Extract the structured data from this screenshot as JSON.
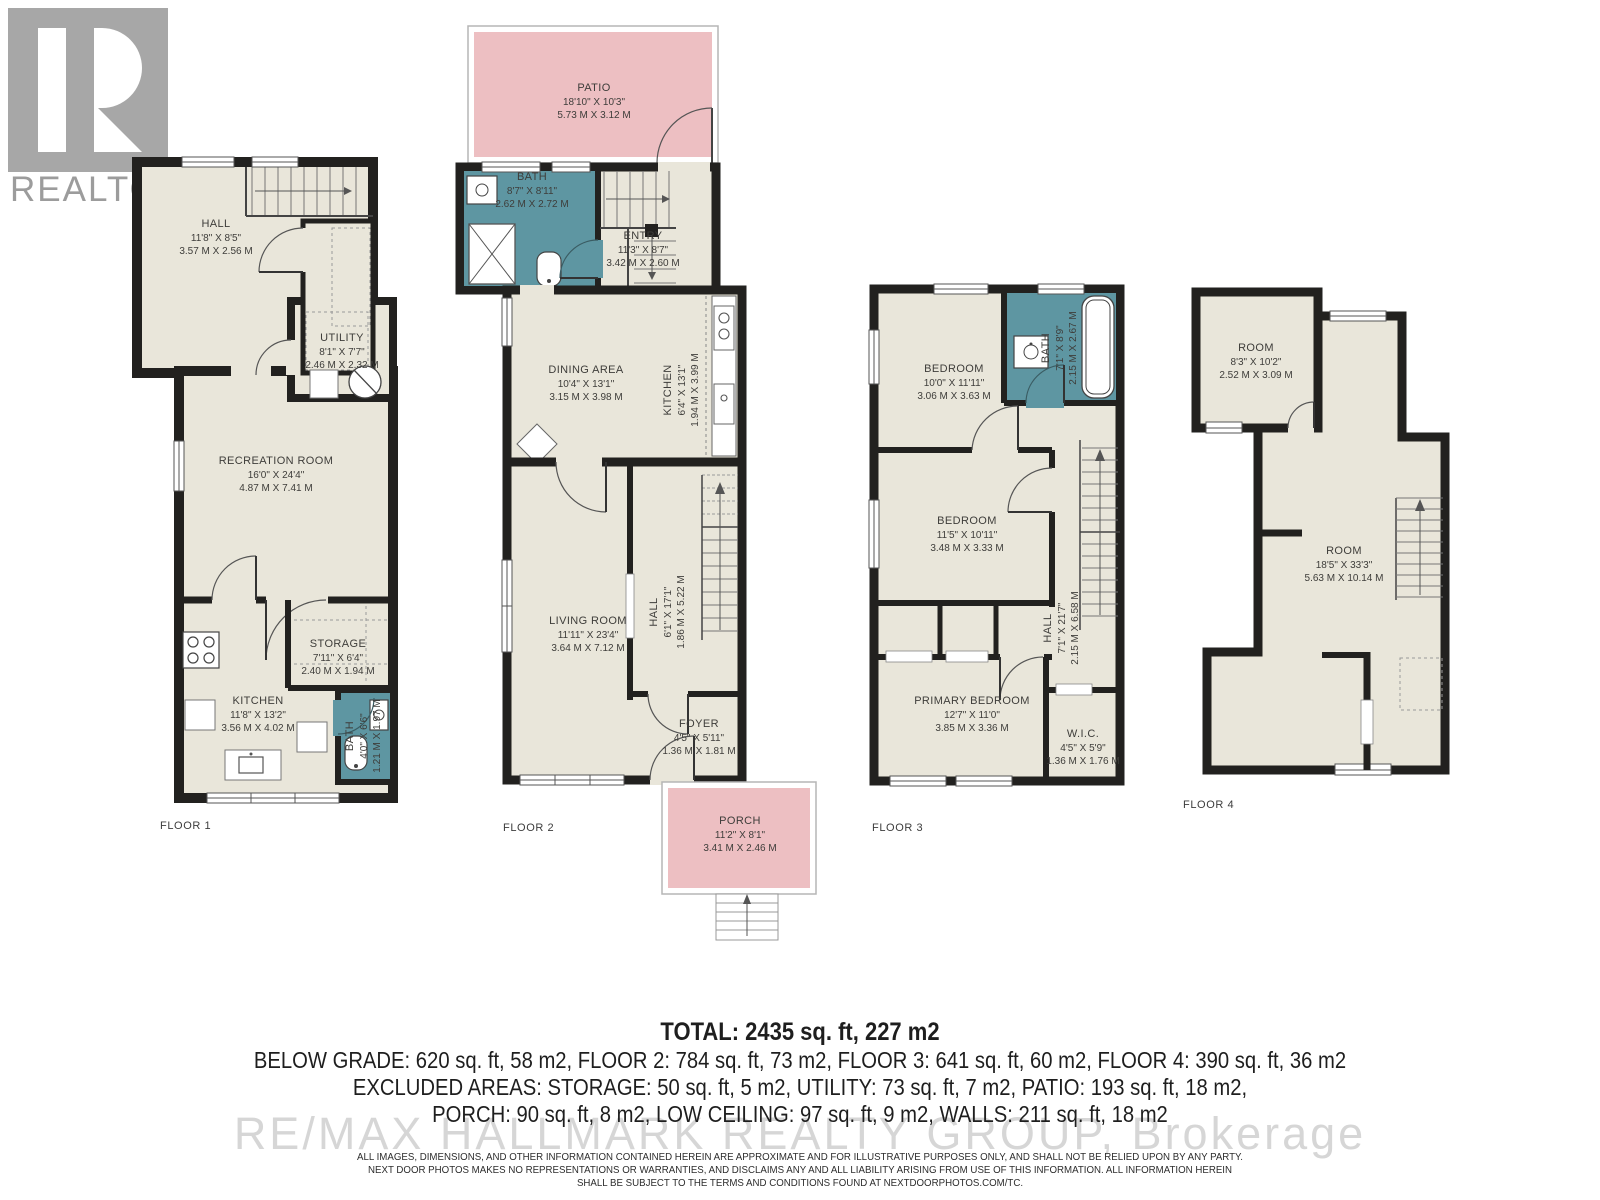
{
  "branding": {
    "logo_letter": "R",
    "logo_text": "REALTOR",
    "logo_reg": "®",
    "watermark": "RE/MAX HALLMARK REALTY GROUP, Brokerage"
  },
  "colors": {
    "floor_fill": "#e9e6da",
    "wall": "#22211f",
    "bath_fill": "#5e96a2",
    "outdoor_fill": "#edbfc2",
    "label_text": "#3e3d3a"
  },
  "floors": [
    {
      "label": "FLOOR 1",
      "rooms": [
        {
          "name": "HALL",
          "imperial": "11'8\" X 8'5\"",
          "metric": "3.57 M X 2.56 M"
        },
        {
          "name": "UTILITY",
          "imperial": "8'1\" X 7'7\"",
          "metric": "2.46 M X 2.32 M"
        },
        {
          "name": "RECREATION ROOM",
          "imperial": "16'0\" X 24'4\"",
          "metric": "4.87 M X 7.41 M"
        },
        {
          "name": "STORAGE",
          "imperial": "7'11\" X 6'4\"",
          "metric": "2.40 M X 1.94 M"
        },
        {
          "name": "KITCHEN",
          "imperial": "11'8\" X 13'2\"",
          "metric": "3.56 M X 4.02 M"
        },
        {
          "name": "BATH",
          "imperial": "4'0\" X 6'6\"",
          "metric": "1.21 M X 1.97 M"
        }
      ]
    },
    {
      "label": "FLOOR 2",
      "rooms": [
        {
          "name": "PATIO",
          "imperial": "18'10\" X 10'3\"",
          "metric": "5.73 M X 3.12 M"
        },
        {
          "name": "BATH",
          "imperial": "8'7\" X 8'11\"",
          "metric": "2.62 M X 2.72 M"
        },
        {
          "name": "ENTRY",
          "imperial": "11'3\" X 8'7\"",
          "metric": "3.42 M X 2.60 M"
        },
        {
          "name": "DINING AREA",
          "imperial": "10'4\" X 13'1\"",
          "metric": "3.15 M X 3.98 M"
        },
        {
          "name": "KITCHEN",
          "imperial": "6'4\" X 13'1\"",
          "metric": "1.94 M X 3.99 M"
        },
        {
          "name": "LIVING ROOM",
          "imperial": "11'11\" X 23'4\"",
          "metric": "3.64 M X 7.12 M"
        },
        {
          "name": "HALL",
          "imperial": "6'1\" X 17'1\"",
          "metric": "1.86 M X 5.22 M"
        },
        {
          "name": "FOYER",
          "imperial": "4'5\" X 5'11\"",
          "metric": "1.36 M X 1.81 M"
        },
        {
          "name": "PORCH",
          "imperial": "11'2\" X 8'1\"",
          "metric": "3.41 M X 2.46 M"
        }
      ]
    },
    {
      "label": "FLOOR 3",
      "rooms": [
        {
          "name": "BEDROOM",
          "imperial": "10'0\" X 11'11\"",
          "metric": "3.06 M X 3.63 M"
        },
        {
          "name": "BATH",
          "imperial": "7'1\" X 8'9\"",
          "metric": "2.15 M X 2.67 M"
        },
        {
          "name": "BEDROOM",
          "imperial": "11'5\" X 10'11\"",
          "metric": "3.48 M X 3.33 M"
        },
        {
          "name": "HALL",
          "imperial": "7'1\" X 21'7\"",
          "metric": "2.15 M X 6.58 M"
        },
        {
          "name": "PRIMARY BEDROOM",
          "imperial": "12'7\" X 11'0\"",
          "metric": "3.85 M X 3.36 M"
        },
        {
          "name": "W.I.C.",
          "imperial": "4'5\" X 5'9\"",
          "metric": "1.36 M X 1.76 M"
        }
      ]
    },
    {
      "label": "FLOOR 4",
      "rooms": [
        {
          "name": "ROOM",
          "imperial": "8'3\" X 10'2\"",
          "metric": "2.52 M X 3.09 M"
        },
        {
          "name": "ROOM",
          "imperial": "18'5\" X 33'3\"",
          "metric": "5.63 M X 10.14 M"
        }
      ]
    }
  ],
  "summary": {
    "total": "TOTAL: 2435 sq. ft, 227 m2",
    "line1": "BELOW GRADE: 620 sq. ft, 58 m2, FLOOR 2: 784 sq. ft, 73 m2, FLOOR 3: 641 sq. ft, 60 m2, FLOOR 4: 390 sq. ft, 36 m2",
    "line2": "EXCLUDED AREAS: STORAGE: 50 sq. ft, 5 m2, UTILITY: 73 sq. ft, 7 m2, PATIO: 193 sq. ft, 18 m2,",
    "line3": "PORCH: 90 sq. ft, 8 m2, LOW CEILING: 97 sq. ft, 9 m2, WALLS: 211 sq. ft, 18 m2"
  },
  "disclaimer": {
    "line1": "ALL IMAGES, DIMENSIONS, AND OTHER INFORMATION CONTAINED HEREIN ARE APPROXIMATE AND FOR ILLUSTRATIVE PURPOSES ONLY, AND SHALL NOT BE RELIED UPON BY ANY PARTY.",
    "line2": "NEXT DOOR PHOTOS MAKES NO REPRESENTATIONS OR WARRANTIES, AND DISCLAIMS ANY AND ALL LIABILITY ARISING FROM USE OF THIS INFORMATION. ALL INFORMATION HEREIN",
    "line3": "SHALL BE SUBJECT TO THE TERMS AND CONDITIONS FOUND AT NEXTDOORPHOTOS.COM/TC."
  }
}
